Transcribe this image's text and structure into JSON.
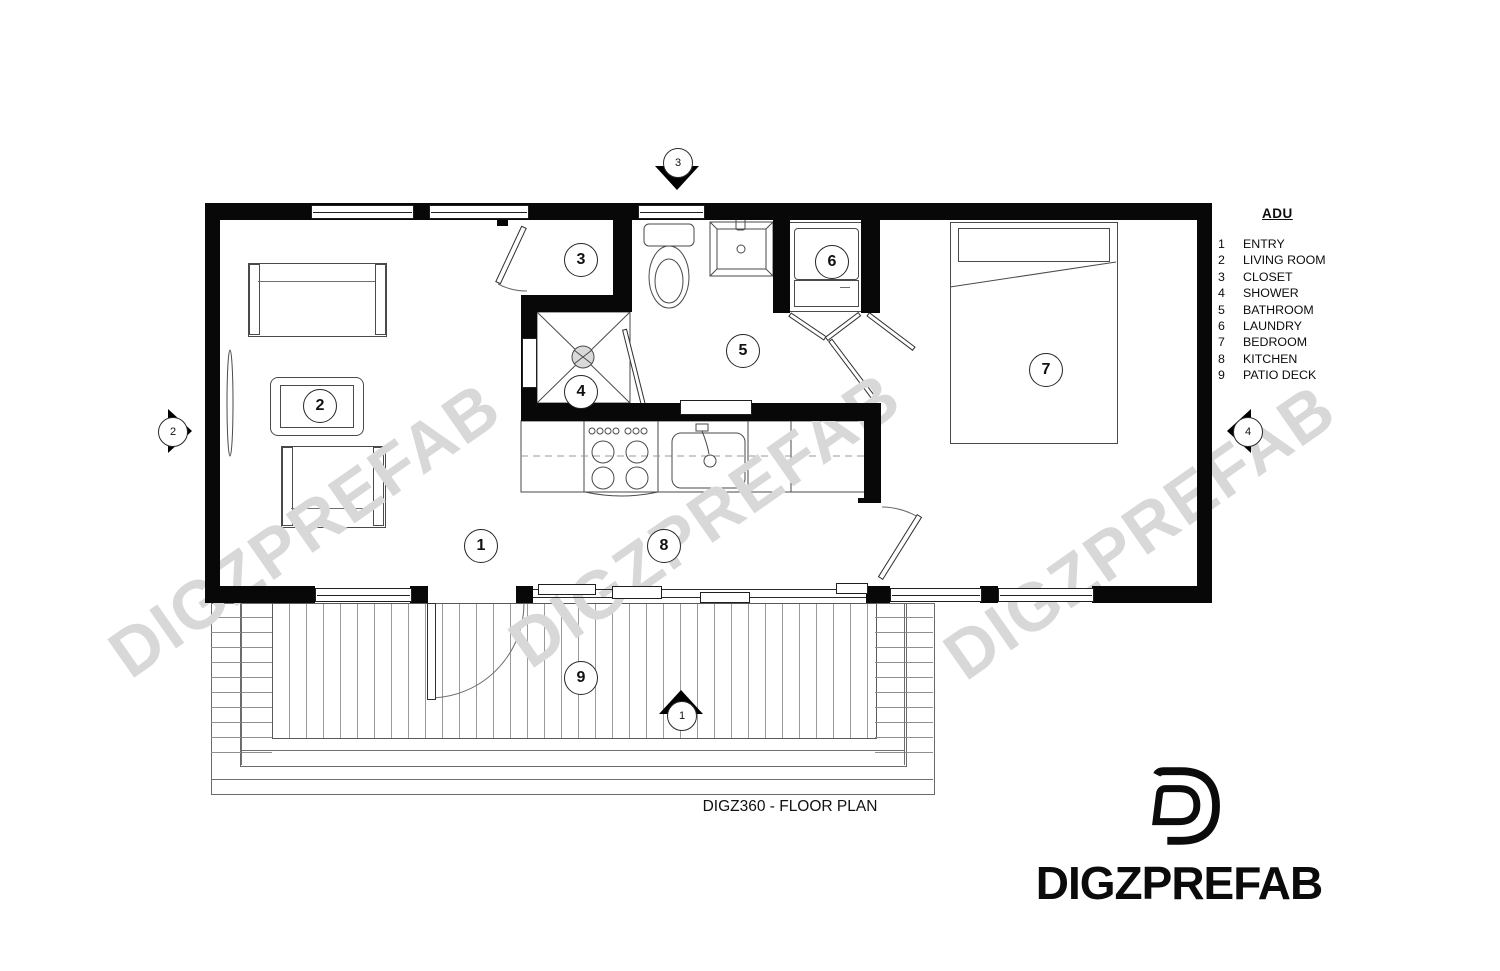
{
  "document": {
    "title": "DIGZ360 - FLOOR PLAN",
    "legend": {
      "title": "ADU",
      "items": [
        {
          "num": "1",
          "label": "ENTRY"
        },
        {
          "num": "2",
          "label": "LIVING ROOM"
        },
        {
          "num": "3",
          "label": "CLOSET"
        },
        {
          "num": "4",
          "label": "SHOWER"
        },
        {
          "num": "5",
          "label": "BATHROOM"
        },
        {
          "num": "6",
          "label": "LAUNDRY"
        },
        {
          "num": "7",
          "label": "BEDROOM"
        },
        {
          "num": "8",
          "label": "KITCHEN"
        },
        {
          "num": "9",
          "label": "PATIO DECK"
        }
      ]
    },
    "section_markers": [
      {
        "num": "1"
      },
      {
        "num": "2"
      },
      {
        "num": "3"
      },
      {
        "num": "4"
      }
    ]
  },
  "brand": {
    "logo_text": "DIGZPREFAB",
    "watermark_text": "DIGZPREFAB"
  },
  "colors": {
    "wall": "#000000",
    "drawing_line": "#4a4a4a",
    "watermark": "#d8d8d8"
  }
}
